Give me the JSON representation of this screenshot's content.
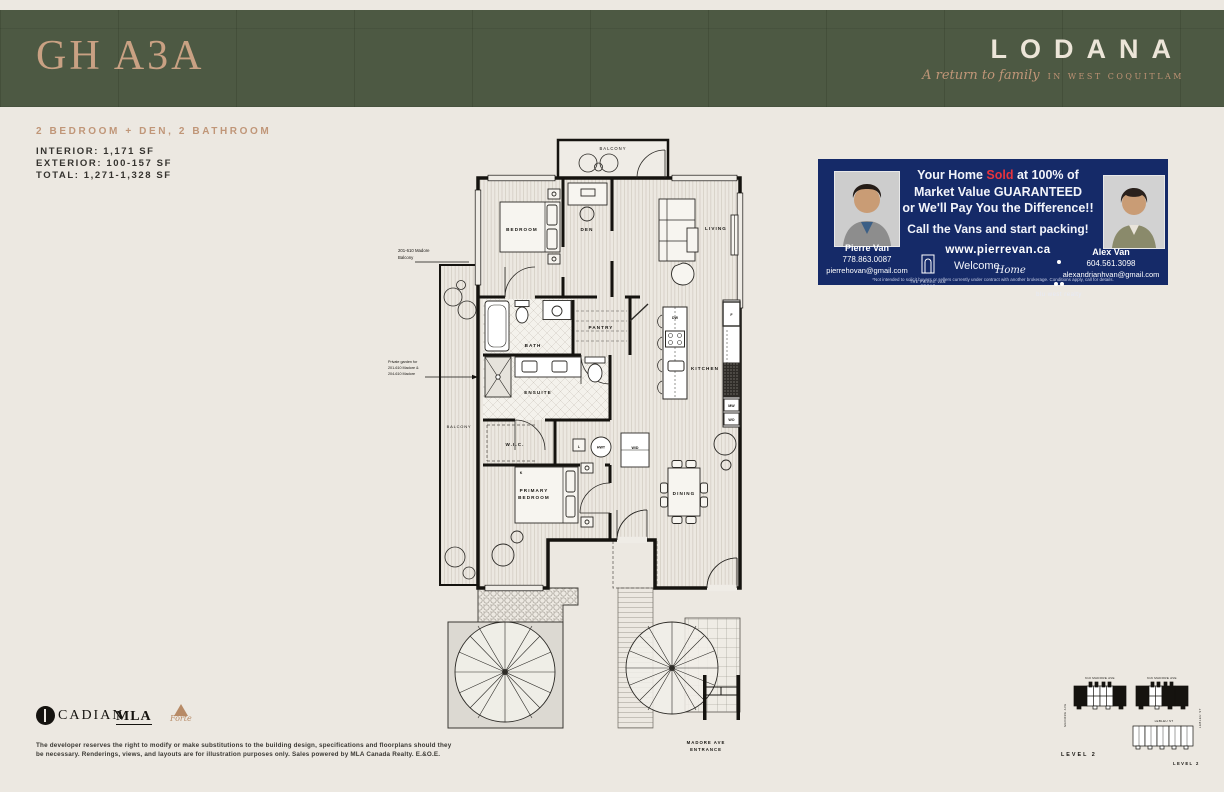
{
  "header": {
    "unit_title": "GH A3A",
    "brand": "LODANA",
    "tagline": "A return to family",
    "location": "IN WEST COQUITLAM",
    "band_color": "#4d5943",
    "accent_color": "#c9a183"
  },
  "summary": {
    "type_line": "2 BEDROOM + DEN, 2 BATHROOM",
    "interior": "INTERIOR: 1,171 SF",
    "exterior": "EXTERIOR: 100-157 SF",
    "total": "TOTAL: 1,271-1,328 SF"
  },
  "ad": {
    "bg_color": "#152a68",
    "sold_color": "#e8333d",
    "headline_pre": "Your Home ",
    "headline_sold": "Sold",
    "headline_post": " at 100% of",
    "headline_line2": "Market Value GUARANTEED",
    "headline_line3": "or We'll Pay You the Difference!!",
    "cta": "Call the Vans and start packing!",
    "website": "www.pierrevan.ca",
    "agent_left": {
      "name": "Pierre Van",
      "phone": "778.863.0087",
      "email": "pierrehovan@gmail.com"
    },
    "agent_right": {
      "name": "Alex Van",
      "phone": "604.561.3098",
      "email": "alexandrianhvan@gmail.com"
    },
    "group_label": "THE PIERRE VAN GROUP",
    "welcome_pre": "Welcome",
    "welcome_script": "Home",
    "brokerage": "blu west realty",
    "fine_print": "*Not intended to solicit buyers or sellers currently under contract with another brokerage. Conditions apply, call for details."
  },
  "floorplan": {
    "labels": {
      "balcony_top": "BALCONY",
      "bedroom": "BEDROOM",
      "den": "DEN",
      "living": "LIVING",
      "bath": "BATH",
      "pantry": "PANTRY",
      "ensuite": "ENSUITE",
      "wic": "W.I.C.",
      "kitchen": "KITCHEN",
      "primary_l1": "PRIMARY",
      "primary_l2": "BEDROOM",
      "dining": "DINING",
      "balcony_left": "BALCONY",
      "wd": "W/D",
      "hwt": "HWT",
      "l": "L",
      "f": "F",
      "dw": "DW",
      "mw": "MW",
      "wo": "WO",
      "k": "K",
      "entrance_l1": "MADORE AVE",
      "entrance_l2": "ENTRANCE"
    },
    "annotations": {
      "a1_l1": "201-610 Madore",
      "a1_l2": "Balcony",
      "a2_l1": "Private garden for",
      "a2_l2": "201-610 Madore &",
      "a2_l3": "204-610 Madore"
    }
  },
  "keyplan": {
    "building1": "610 MADORE AVE",
    "building2": "616 MADORE AVE",
    "building3": "LEBLEU ST",
    "street_left": "MADORE AVE",
    "street_right": "LEBLEU ST",
    "level_a": "LEVEL 2",
    "level_b": "LEVEL 2"
  },
  "footer": {
    "logo_cadian": "CADIAN",
    "logo_mla": "MLA",
    "logo_forte": "Forte",
    "disclaimer_l1": "The developer reserves the right to modify or make substitutions to the building design, specifications and floorplans should they",
    "disclaimer_l2": "be necessary. Renderings, views, and layouts are for illustration purposes only. Sales powered by MLA Canada Realty. E.&O.E."
  }
}
